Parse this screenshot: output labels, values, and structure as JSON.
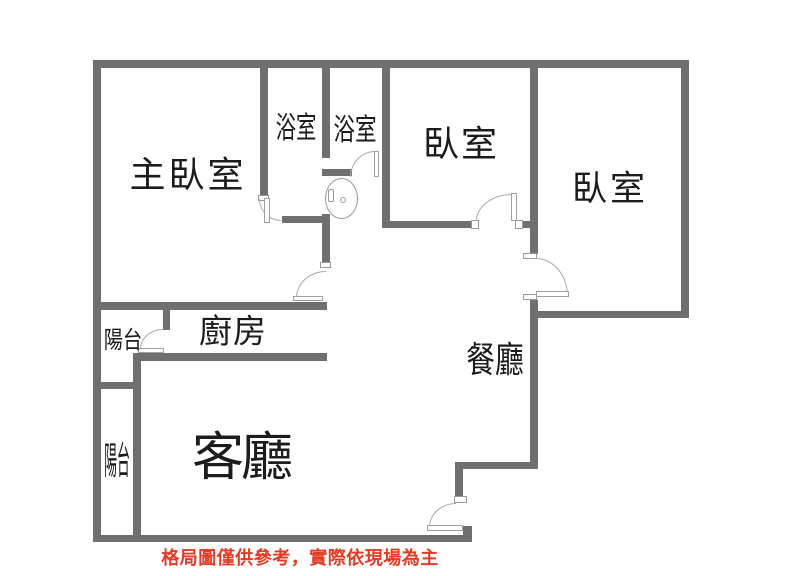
{
  "rooms": {
    "master_bedroom": {
      "label": "主臥室"
    },
    "bathroom_1": {
      "label": "浴室"
    },
    "bathroom_2": {
      "label": "浴室"
    },
    "bedroom_1": {
      "label": "臥室"
    },
    "bedroom_2": {
      "label": "臥室"
    },
    "balcony_1": {
      "label": "陽台"
    },
    "balcony_2": {
      "label": "陽台"
    },
    "kitchen": {
      "label": "廚房"
    },
    "living_room": {
      "label": "客廳"
    },
    "dining_room": {
      "label": "餐廳"
    }
  },
  "disclaimer": "格局圖僅供參考，實際依現場為主",
  "colors": {
    "wall": "#6f6f6f",
    "door_line": "#aaaaaa",
    "label_text": "#1c1c1c",
    "disclaimer_text": "#e63a22",
    "background": "#ffffff"
  }
}
